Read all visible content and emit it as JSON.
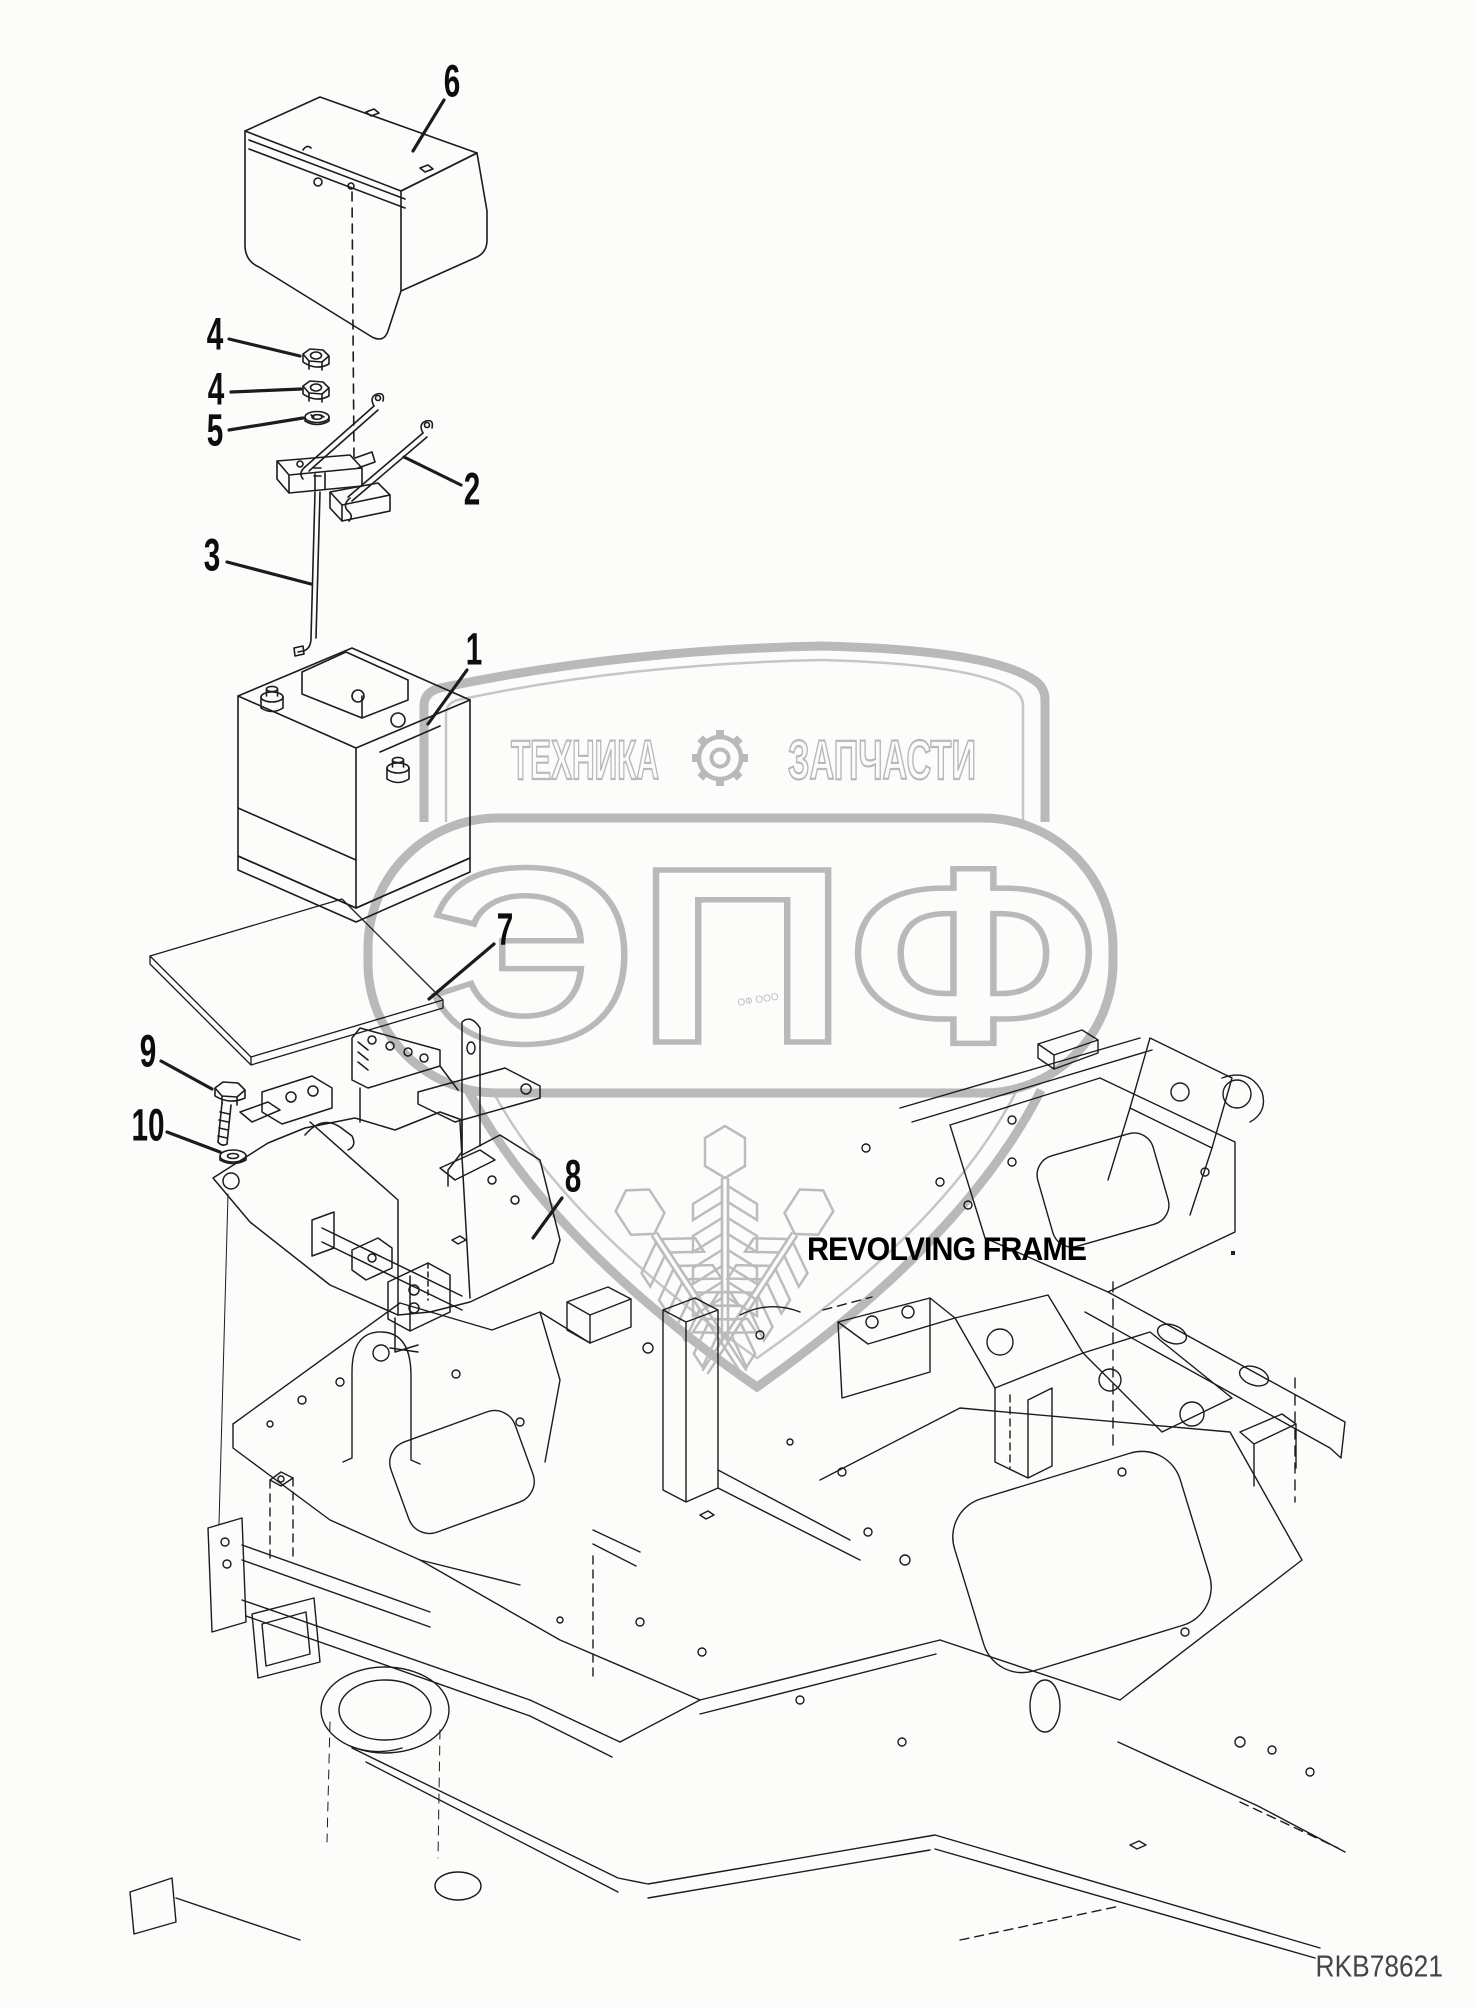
{
  "page": {
    "background": "#fcfcfb",
    "line_color": "#1c1c1c",
    "watermark_color": "#b9b9b9",
    "drawing_code": "RKB78621",
    "frame_caption": "REVOLVING FRAME"
  },
  "callouts": [
    {
      "num": "6",
      "x": 452,
      "y": 83
    },
    {
      "num": "4",
      "x": 215,
      "y": 336
    },
    {
      "num": "4",
      "x": 216,
      "y": 391
    },
    {
      "num": "5",
      "x": 215,
      "y": 432
    },
    {
      "num": "2",
      "x": 472,
      "y": 491
    },
    {
      "num": "3",
      "x": 212,
      "y": 557
    },
    {
      "num": "1",
      "x": 474,
      "y": 651
    },
    {
      "num": "7",
      "x": 505,
      "y": 931
    },
    {
      "num": "9",
      "x": 148,
      "y": 1053
    },
    {
      "num": "10",
      "x": 148,
      "y": 1127
    },
    {
      "num": "8",
      "x": 573,
      "y": 1178
    }
  ],
  "watermark": {
    "title_left": "ТЕХНИКА",
    "title_right": "ЗАПЧАСТИ",
    "letters": "ЭПФ",
    "fine_print": "ОФ ООО",
    "icon": "gear-icon",
    "color": "#b9b9b9"
  },
  "stray_mark": "."
}
